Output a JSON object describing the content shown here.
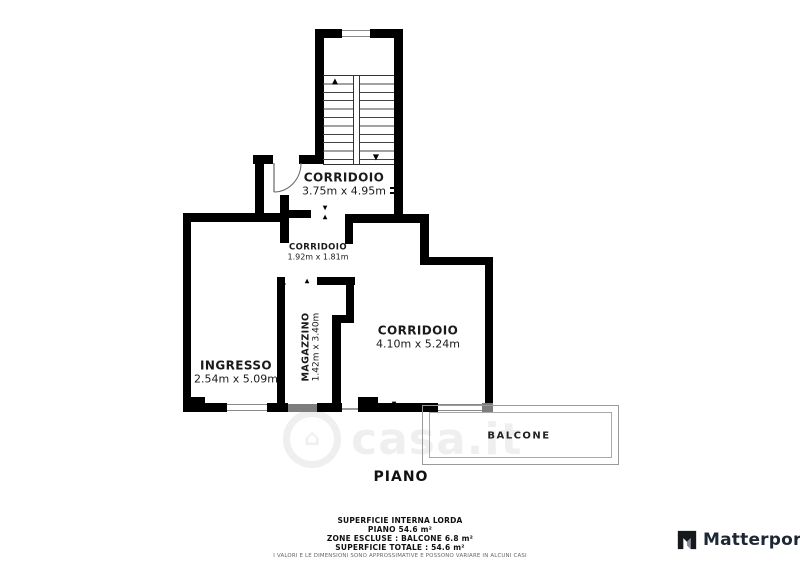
{
  "colors": {
    "wall": "#000000",
    "window_line": "#8a8a8a",
    "ramp_gray": "#7d7d7d",
    "balcony_border": "#9a9a9a",
    "text": "#1a1a1a",
    "disclaimer_text": "#666666",
    "logo_text": "#1d2836"
  },
  "rooms": {
    "corridoio_top": {
      "name": "CORRIDOIO",
      "dims": "3.75m x 4.95m"
    },
    "corridoio_mid": {
      "name": "CORRIDOIO",
      "dims": "1.92m x 1.81m"
    },
    "corridoio_right": {
      "name": "CORRIDOIO",
      "dims": "4.10m x 5.24m"
    },
    "ingresso": {
      "name": "INGRESSO",
      "dims": "2.54m x 5.09m"
    },
    "magazzino": {
      "name": "MAGAZZINO",
      "dims": "1.42m x 3.40m"
    },
    "balcone": {
      "name": "BALCONE"
    }
  },
  "floor_label": "PIANO",
  "watermark": {
    "text": "casa.it",
    "house_glyph": "⌂"
  },
  "stairs": {
    "up_arrow": "▲",
    "down_arrow": "▼"
  },
  "footer": {
    "line1": "SUPERFICIE INTERNA LORDA",
    "line2": "PIANO 54.6 m²",
    "line3": "ZONE ESCLUSE :  BALCONE 6.8 m²",
    "line4": "SUPERFICIE TOTALE :  54.6 m²",
    "disclaimer": "I VALORI E LE DIMENSIONI SONO APPROSSIMATIVE E POSSONO VARIARE IN ALCUNI CASI"
  },
  "branding": {
    "name": "Matterport"
  }
}
